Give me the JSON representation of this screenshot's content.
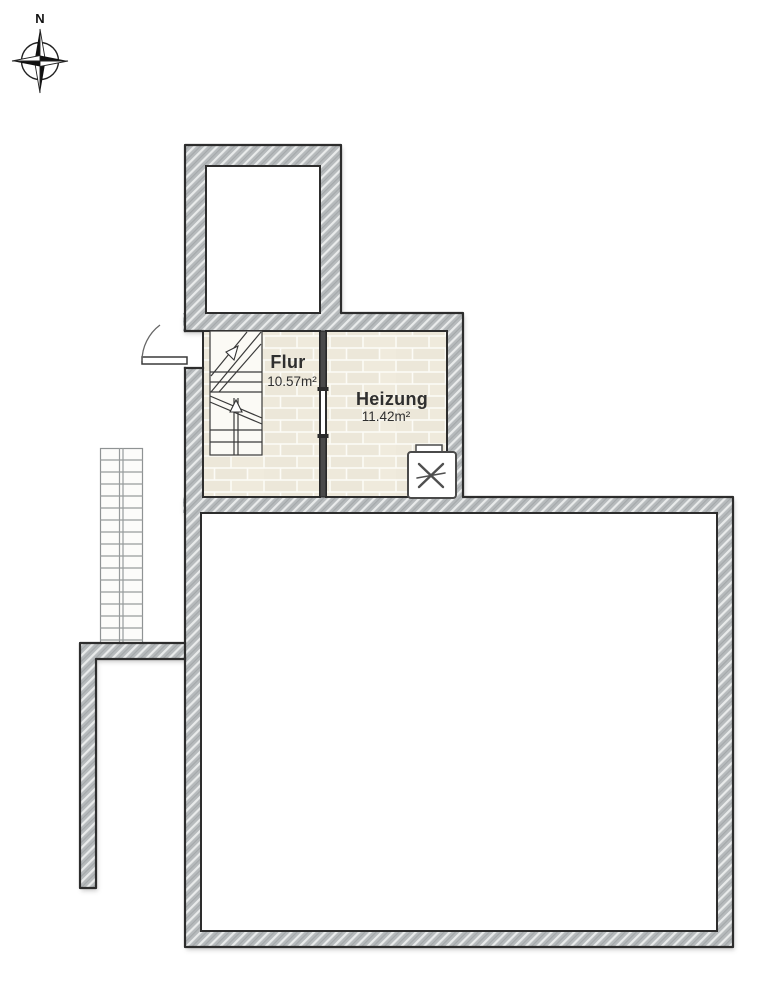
{
  "document": {
    "type": "floor-plan",
    "background": "#ffffff"
  },
  "compass": {
    "north_label": "N",
    "icon": "compass-rose-icon"
  },
  "rooms": [
    {
      "name": "Flur",
      "area": "10.57m²"
    },
    {
      "name": "Heizung",
      "area": "11.42m²"
    }
  ],
  "fixtures": {
    "boiler_icon": "x-cross-appliance",
    "interior_staircase": "winder-stair-up-arrow",
    "exterior_staircase": "straight-run-treads",
    "entry_door": "quarter-circle-swing"
  },
  "colors": {
    "wall_fill": "#b7bbbd",
    "wall_hatch": "#eef0f0",
    "wall_outline": "#2d2d2d",
    "floor_brick": "#ece7d9",
    "floor_joint": "#fcfbf6",
    "label_text": "#2f2f2f"
  }
}
